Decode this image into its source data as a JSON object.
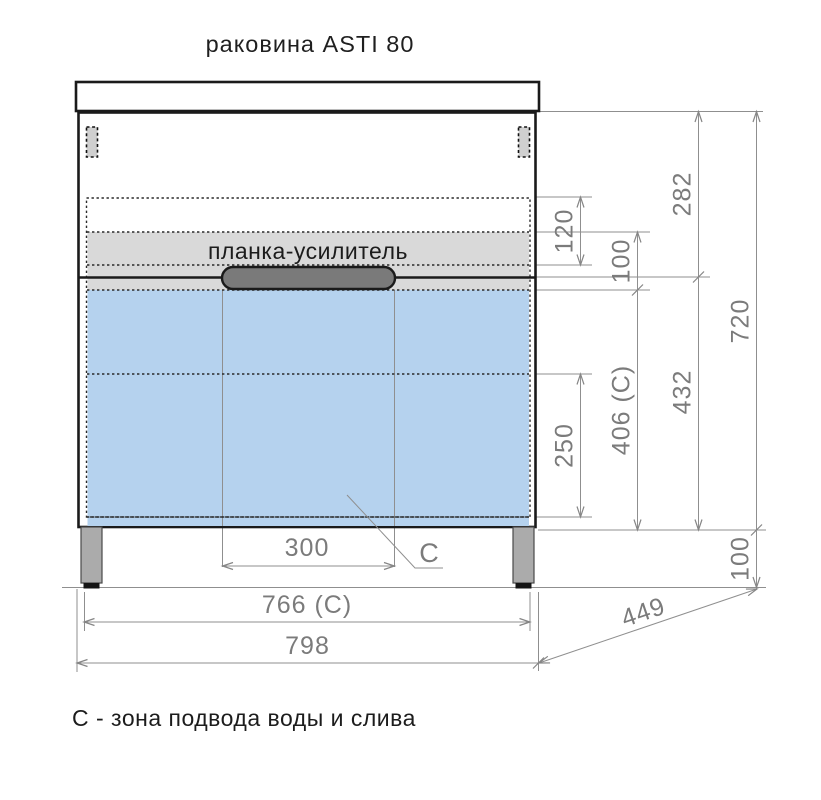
{
  "title": "раковина ASTI 80",
  "cabinet": {
    "reinforcement_label": "планка-усилитель",
    "zone_marker": "С"
  },
  "dimensions": {
    "top_section_height": "282",
    "gap_height": "120",
    "strip_height": "100",
    "total_height": "720",
    "lower_section_height": "432",
    "zone_c_height": "406 (С)",
    "drain_zone_offset": "250",
    "handle_width": "300",
    "zone_c_width": "766 (С)",
    "total_width": "798",
    "depth": "449",
    "leg_height": "100"
  },
  "footnote": "С - зона подвода воды и слива",
  "colors": {
    "outline_black": "#1a1a1a",
    "dimension_gray": "#8f8f8f",
    "dimension_text_gray": "#7b7b7b",
    "zone_c_blue": "#b5d2ee",
    "strip_gray": "#d9d9d9",
    "handle_gray": "#7a7a7a"
  }
}
